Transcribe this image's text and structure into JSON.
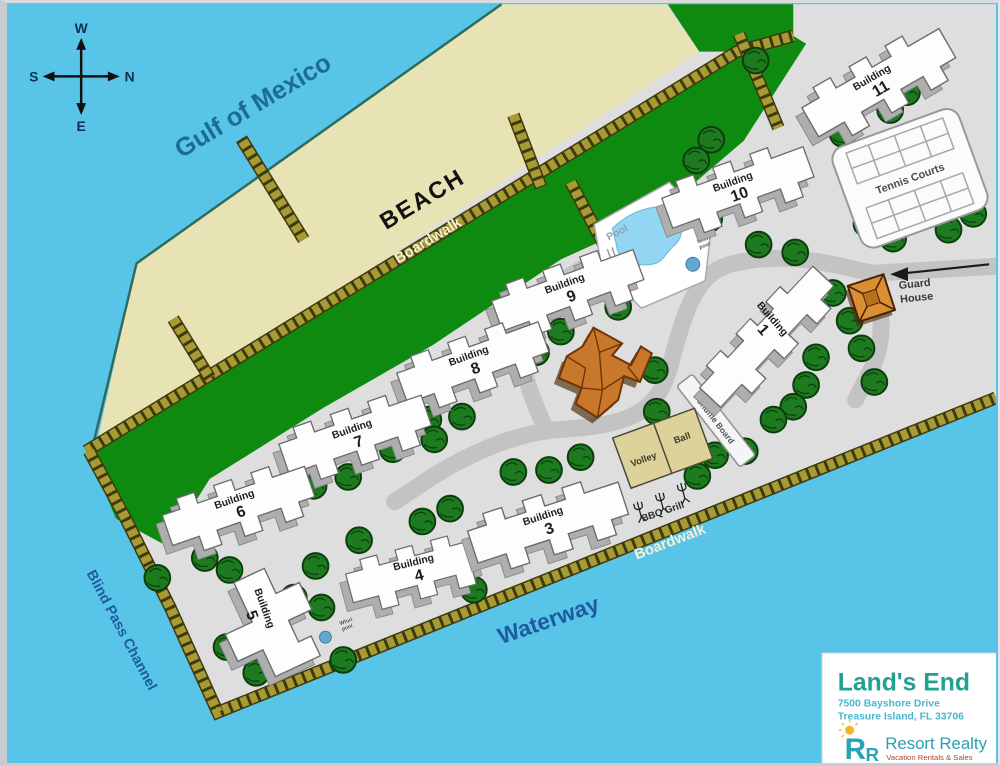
{
  "map": {
    "compass": {
      "west": "W",
      "north": "N",
      "south": "S",
      "east": "E"
    },
    "water": {
      "gulf": "Gulf of Mexico",
      "waterway": "Waterway",
      "channel": "Blind Pass Channel"
    },
    "beach_label": "BEACH",
    "boardwalk_upper": "Boardwalk",
    "boardwalk_lower": "Boardwalk",
    "buildings": [
      {
        "name": "Building",
        "num": "11"
      },
      {
        "name": "Building",
        "num": "10"
      },
      {
        "name": "Building",
        "num": "9"
      },
      {
        "name": "Building",
        "num": "8"
      },
      {
        "name": "Building",
        "num": "7"
      },
      {
        "name": "Building",
        "num": "6"
      },
      {
        "name": "Building",
        "num": "5"
      },
      {
        "name": "Building",
        "num": "4"
      },
      {
        "name": "Building",
        "num": "3"
      },
      {
        "name": "Building",
        "num": "1"
      }
    ],
    "amenities": {
      "tennis": "Tennis Courts",
      "pool": "Pool",
      "whirlpool_line1": "Whirl",
      "whirlpool_line2": "pool",
      "whirlpool2_line1": "Whirl",
      "whirlpool2_line2": "pool",
      "guard_line1": "Guard",
      "guard_line2": "House",
      "shuffle": "Shuffle Board",
      "volley_left": "Volley",
      "volley_right": "Ball",
      "bbq": "BBQ Grill"
    },
    "info_box": {
      "title": "Land's End",
      "address_line1": "7500 Bayshore Drive",
      "address_line2": "Treasure Island, FL 33706"
    },
    "brand": {
      "monogram_large": "R",
      "monogram_small": "R",
      "name": "Resort Realty",
      "tagline": "Vacation Rentals & Sales"
    },
    "colors": {
      "water": "#58c5e8",
      "sand": "#e7e3b4",
      "grass": "#0f8a10",
      "pavement": "#dedede",
      "road": "#c3c3c3",
      "boardwalk": "#a89b33",
      "building": "#fdfdfd",
      "clubhouse": "#c8772b",
      "guard_house": "#da8f33",
      "brand_teal": "#21a093",
      "brand_blue": "#4db4ce",
      "tagline_red": "#b5402e"
    }
  }
}
